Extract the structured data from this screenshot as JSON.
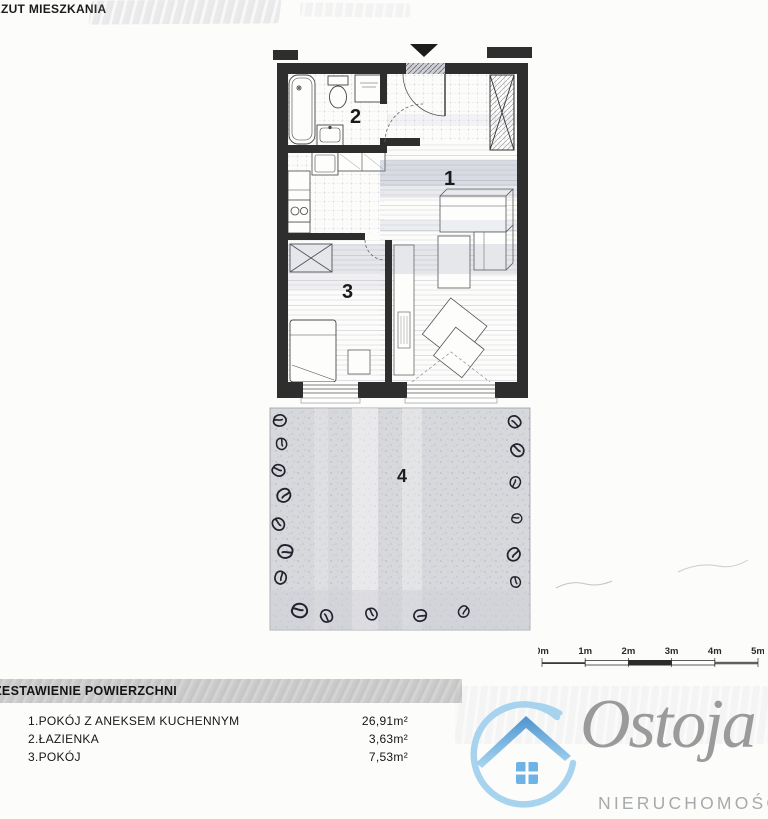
{
  "title": "RZUT MIESZKANIA",
  "plan": {
    "rooms": [
      {
        "number": "1"
      },
      {
        "number": "2"
      },
      {
        "number": "3"
      },
      {
        "number": "4"
      }
    ]
  },
  "scalebar": {
    "labels": [
      "0m",
      "1m",
      "2m",
      "3m",
      "4m",
      "5m"
    ]
  },
  "areas": {
    "heading": "ZESTAWIENIE POWIERZCHNI",
    "rows": [
      {
        "name": "1.POKÓJ Z ANEKSEM KUCHENNYM",
        "value": "26,91m²"
      },
      {
        "name": "2.ŁAZIENKA",
        "value": "3,63m²"
      },
      {
        "name": "3.POKÓJ",
        "value": "7,53m²"
      }
    ]
  },
  "logo": {
    "name": "Ostoja",
    "subtitle": "NIERUCHOMOŚCI"
  },
  "colors": {
    "wall_dark": "#2e2e2e",
    "terrace_gray": "#d7d8dc",
    "circle_blue": "#a7d3ef",
    "roof_blue": "#4d94cf",
    "window_blue": "#6fb3e4",
    "logo_text_gray": "#9a9a9a"
  }
}
